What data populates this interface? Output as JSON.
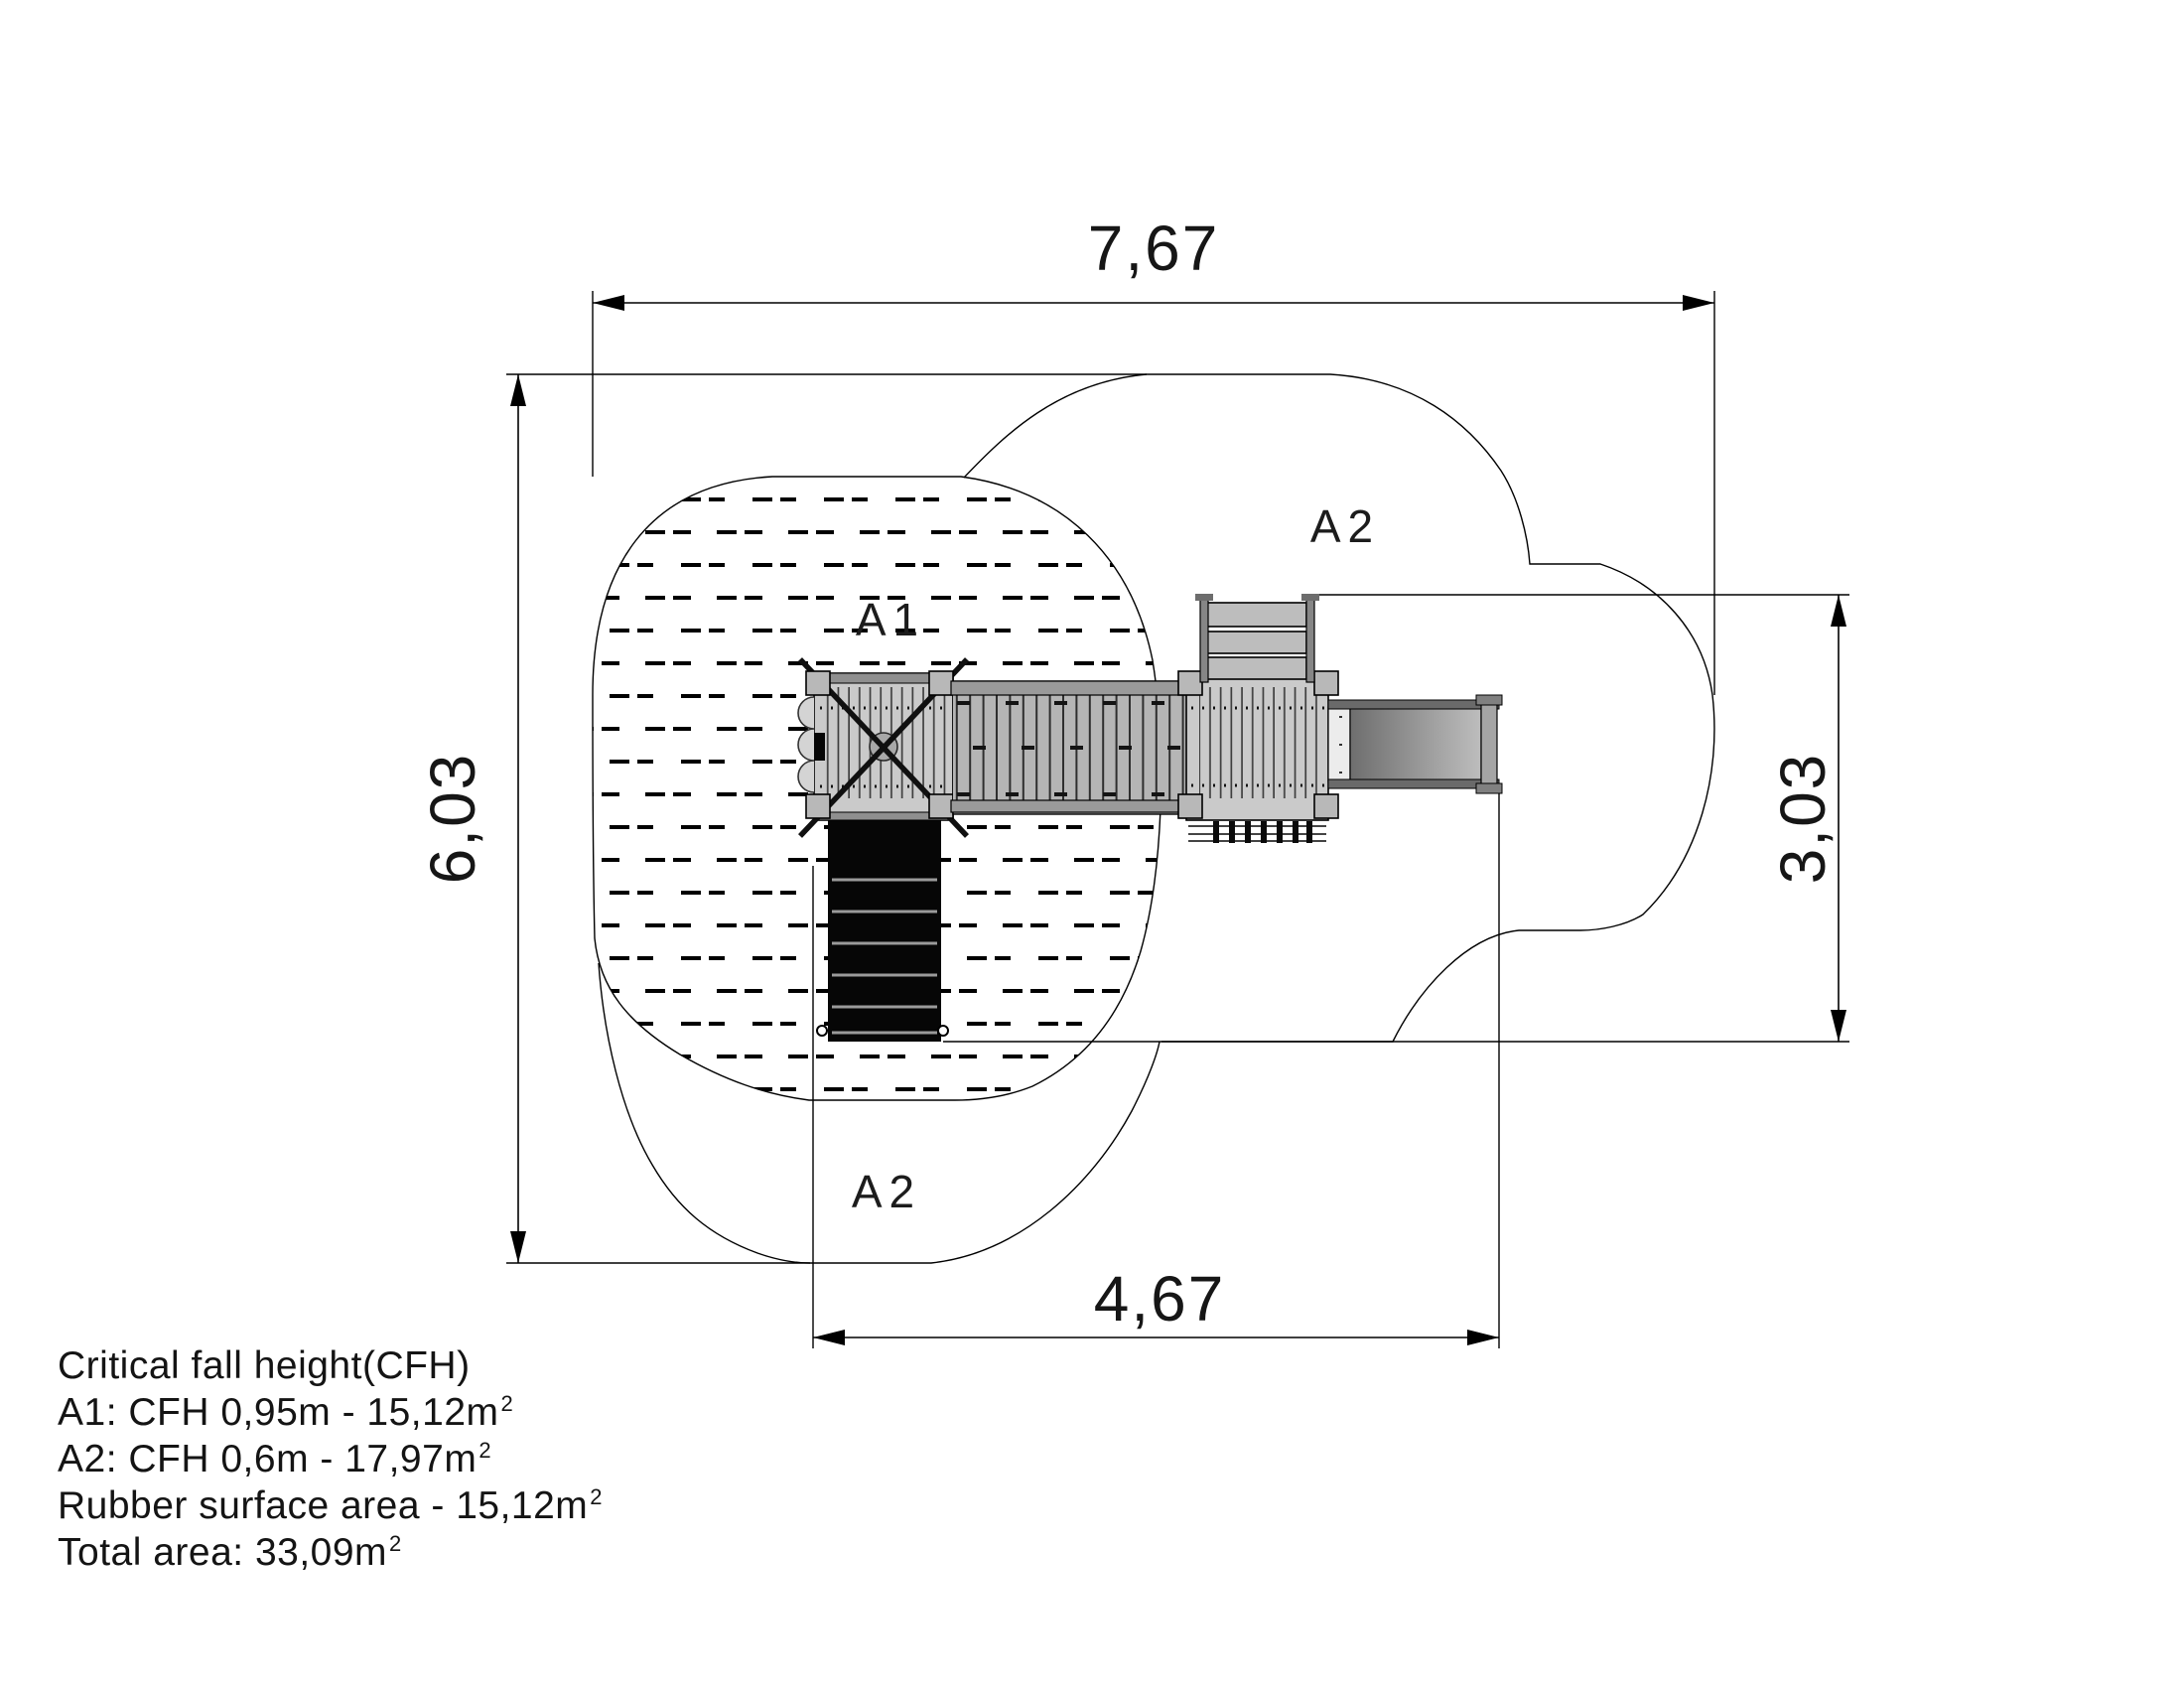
{
  "dims": {
    "top": "7,67",
    "left": "6,03",
    "right": "3,03",
    "bottom": "4,67"
  },
  "zones": {
    "a1": "A1",
    "a2_top": "A2",
    "a2_bottom": "A2"
  },
  "legend": {
    "title": "Critical fall height(CFH)",
    "items": [
      {
        "text": "A1: CFH 0,95m - 15,12m",
        "sup": "2"
      },
      {
        "text": "A2: CFH 0,6m - 17,97m",
        "sup": "2"
      },
      {
        "text": "Rubber surface area - 15,12m",
        "sup": "2"
      },
      {
        "text": "Total area: 33,09m",
        "sup": "2"
      }
    ]
  },
  "colors": {
    "line": "#000000",
    "platform": "#cacaca",
    "bridge": "#b5b5b5",
    "stairs": "#060606",
    "slide_dark": "#6e6e6e",
    "slide_light": "#bdbdbd"
  }
}
